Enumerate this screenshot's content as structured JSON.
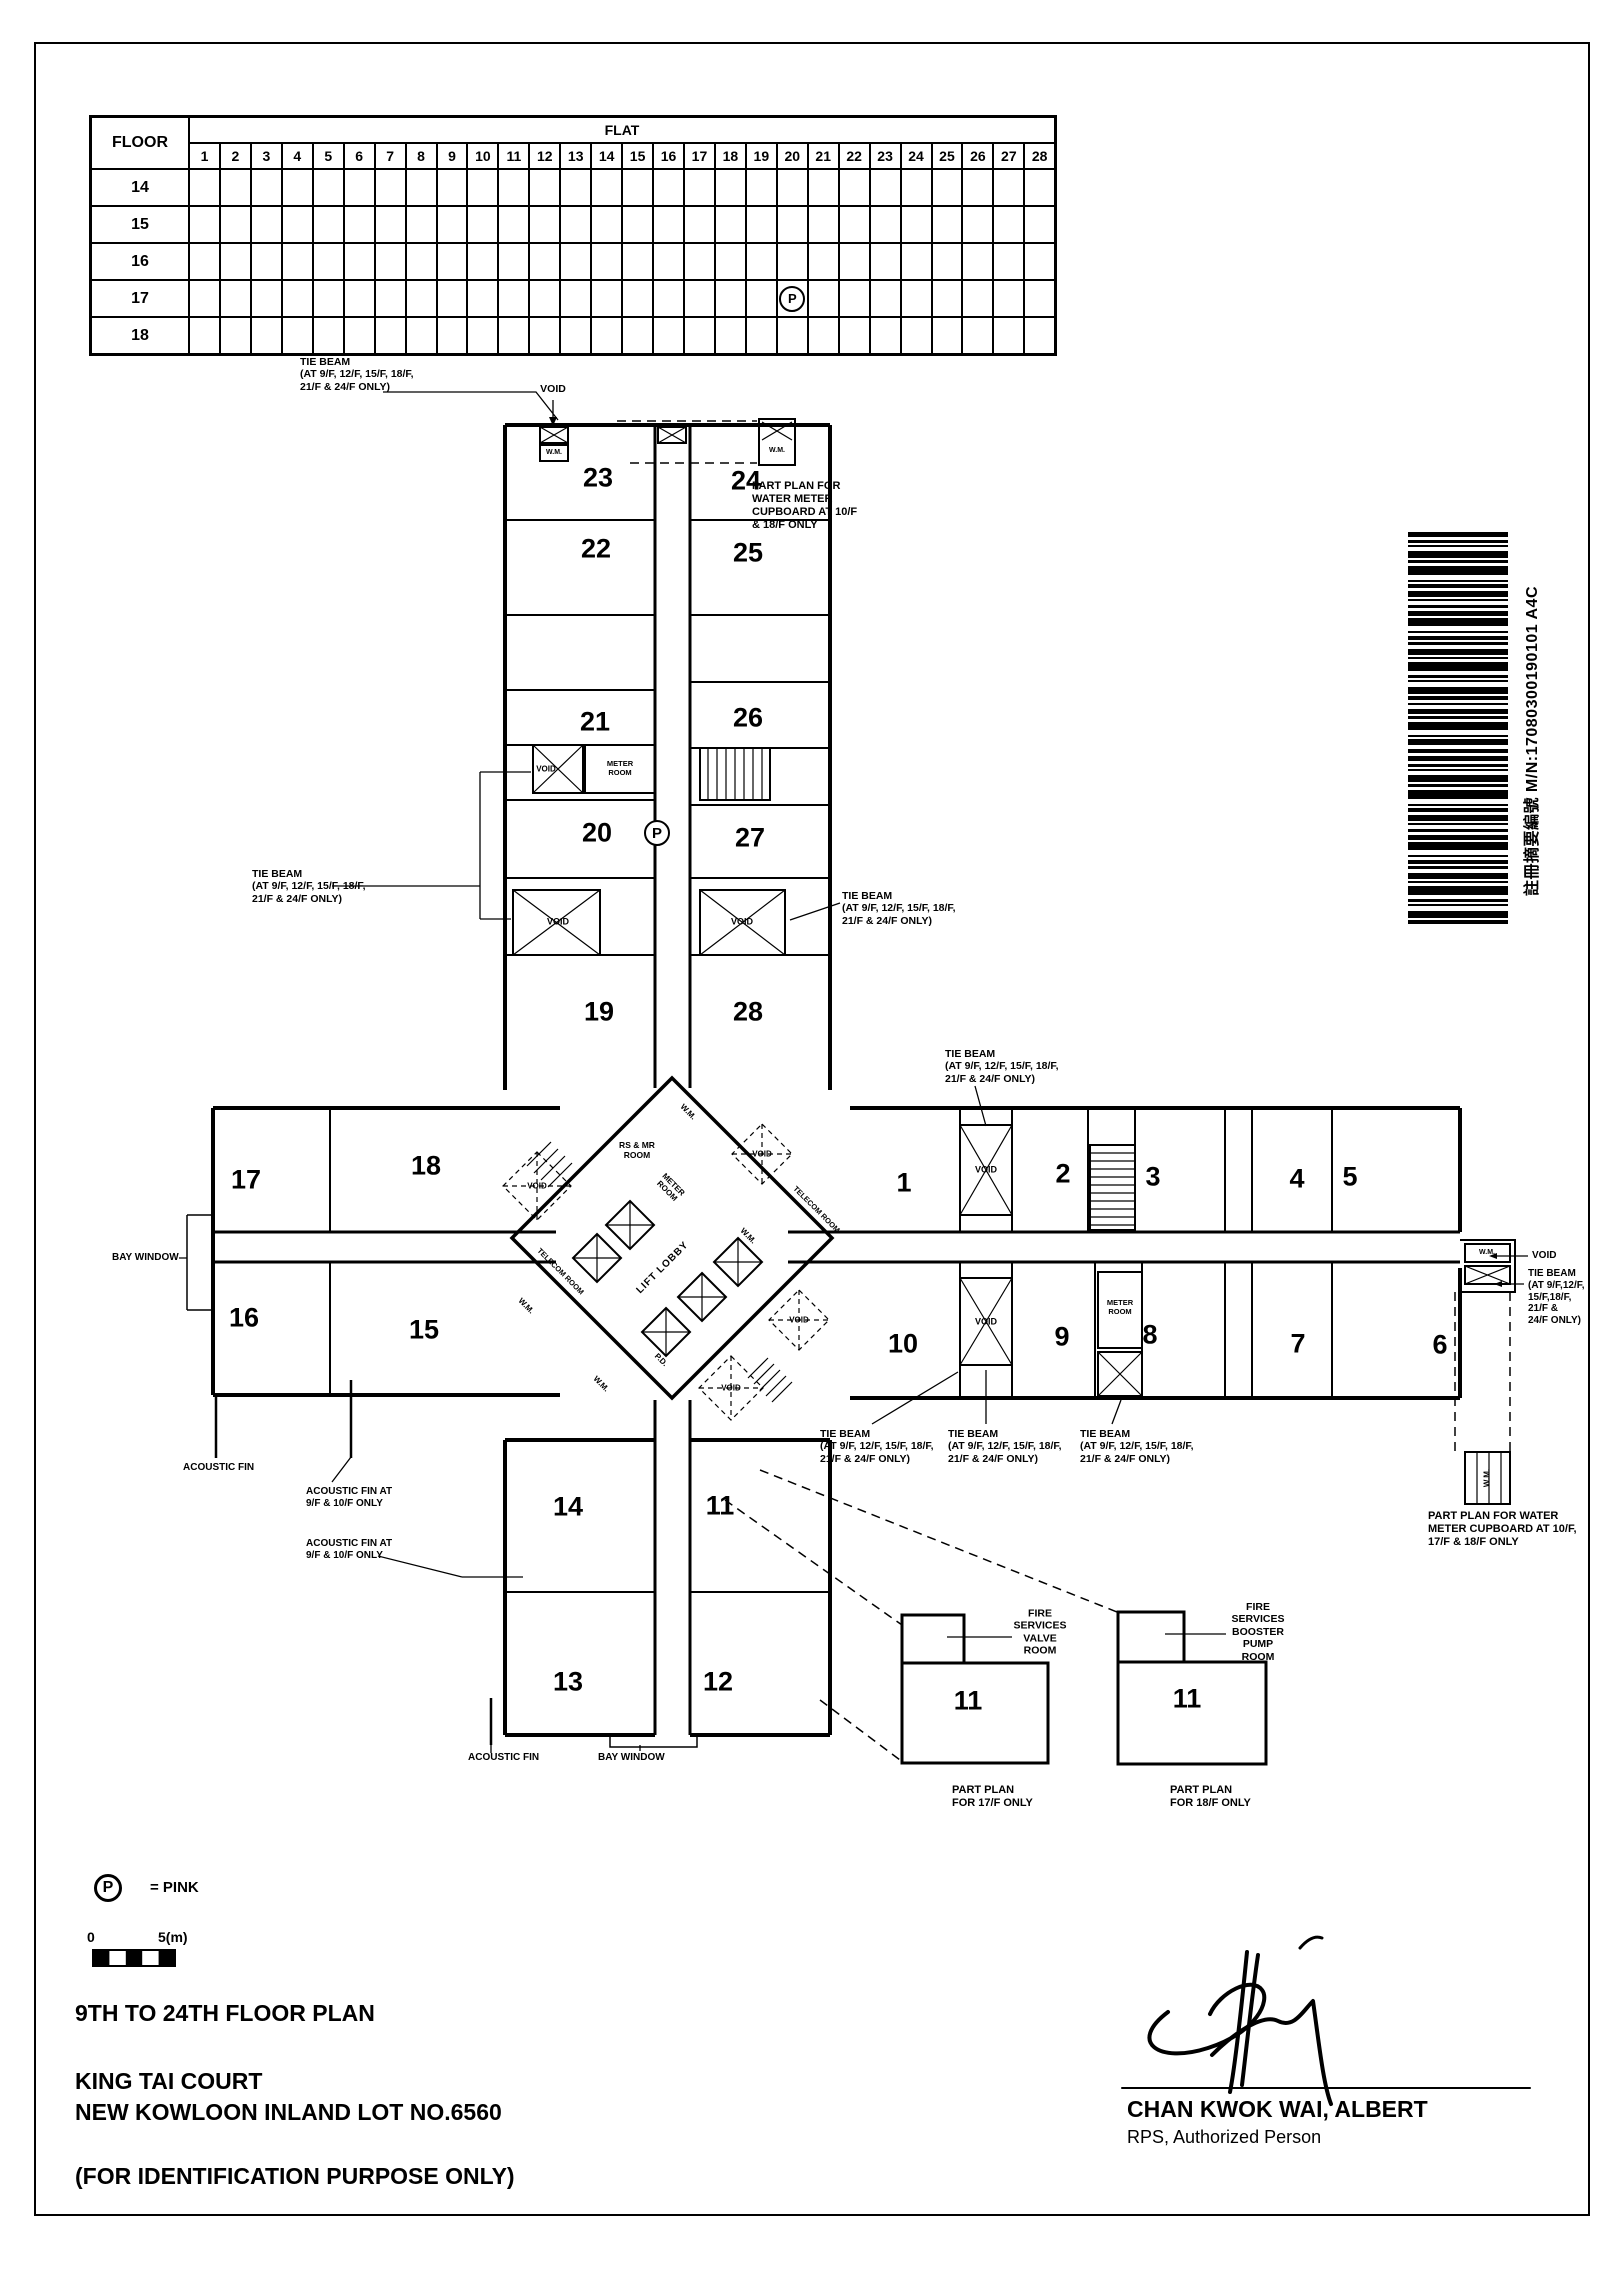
{
  "page": {
    "titles": {
      "plan_title": "9TH TO 24TH FLOOR PLAN",
      "estate_name": "KING TAI COURT",
      "lot_number": "NEW KOWLOON INLAND LOT NO.6560",
      "purpose_note": "(FOR IDENTIFICATION PURPOSE ONLY)"
    },
    "legend": {
      "symbol": "P",
      "symbol_meaning": "= PINK",
      "scale_start": "0",
      "scale_end": "5(m)"
    },
    "signature": {
      "name": "CHAN KWOK WAI, ALBERT",
      "role": "RPS, Authorized Person"
    },
    "barcode_label": "註冊摘要編號   M/N:17080300190101   A4C"
  },
  "table": {
    "floor_header": "FLOOR",
    "flat_header": "FLAT",
    "flat_numbers": [
      "1",
      "2",
      "3",
      "4",
      "5",
      "6",
      "7",
      "8",
      "9",
      "10",
      "11",
      "12",
      "13",
      "14",
      "15",
      "16",
      "17",
      "18",
      "19",
      "20",
      "21",
      "22",
      "23",
      "24",
      "25",
      "26",
      "27",
      "28"
    ],
    "floor_rows": [
      "14",
      "15",
      "16",
      "17",
      "18"
    ],
    "marker": {
      "floor": "17",
      "flat": "20",
      "symbol": "P"
    }
  },
  "plan": {
    "flats": {
      "1": "1",
      "2": "2",
      "3": "3",
      "4": "4",
      "5": "5",
      "6": "6",
      "7": "7",
      "8": "8",
      "9": "9",
      "10": "10",
      "11": "11",
      "12": "12",
      "13": "13",
      "14": "14",
      "15": "15",
      "16": "16",
      "17": "17",
      "18": "18",
      "19": "19",
      "20": "20",
      "21": "21",
      "22": "22",
      "23": "23",
      "24": "24",
      "25": "25",
      "26": "26",
      "27": "27",
      "28": "28",
      "pp17_11": "11",
      "pp18_11": "11"
    },
    "marker_flat": {
      "flat": "20",
      "symbol": "P"
    },
    "annotations": {
      "tie_beam": "TIE BEAM\n(AT 9/F, 12/F, 15/F, 18/F,\n21/F & 24/F ONLY)",
      "tie_beam_right_edge": "TIE BEAM\n(AT 9/F,12/F,\n15/F,18/F,\n21/F &\n24/F ONLY)",
      "void": "VOID",
      "wm": "W.M.",
      "pd": "P.D.",
      "bay_window": "BAY WINDOW",
      "acoustic_fin": "ACOUSTIC FIN",
      "acoustic_fin_9_10": "ACOUSTIC FIN AT\n9/F & 10/F ONLY",
      "part_plan_water_meter_top": "PART PLAN FOR\nWATER METER\nCUPBOARD AT 10/F\n& 18/F ONLY",
      "part_plan_water_meter_right": "PART PLAN FOR WATER\nMETER CUPBOARD AT 10/F,\n17/F & 18/F ONLY",
      "part_plan_17f": "PART PLAN\nFOR 17/F ONLY",
      "part_plan_18f": "PART PLAN\nFOR 18/F ONLY",
      "fire_services_valve": "FIRE\nSERVICES\nVALVE\nROOM",
      "fire_services_booster": "FIRE\nSERVICES\nBOOSTER\nPUMP\nROOM",
      "meter_room": "METER\nROOM",
      "rs_mr_room": "RS & MR\nROOM",
      "lift_lobby": "LIFT LOBBY",
      "telecom_room": "TELECOM ROOM"
    }
  }
}
